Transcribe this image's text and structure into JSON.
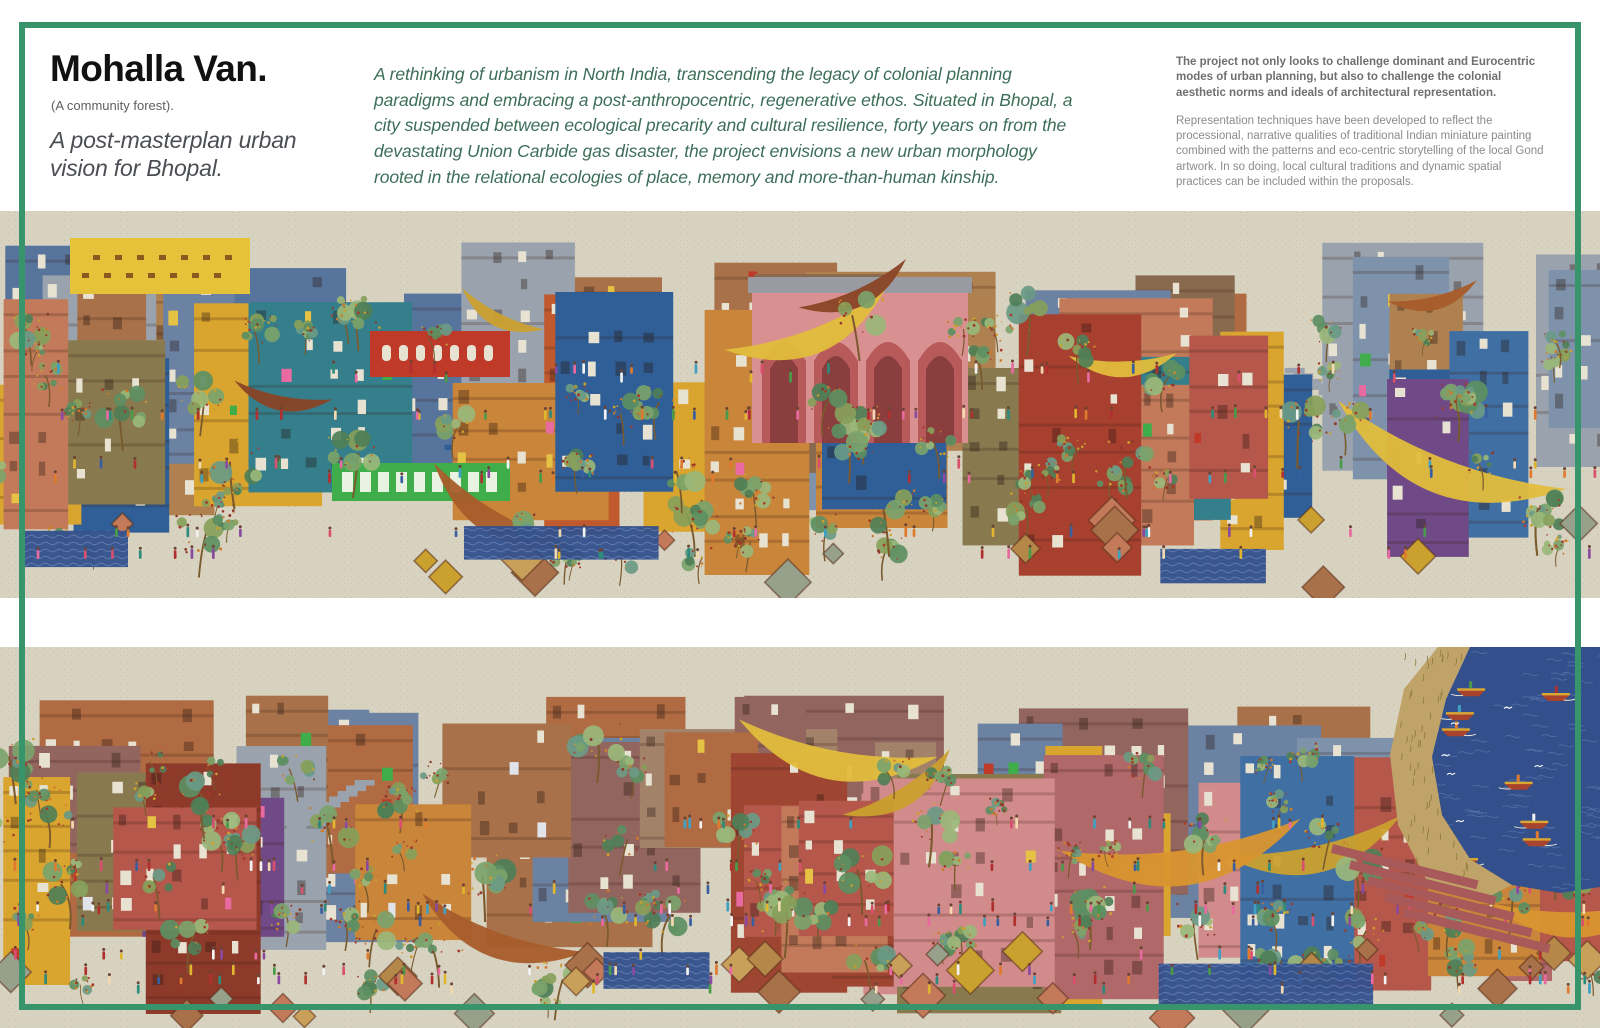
{
  "header": {
    "title": "Mohalla Van.",
    "subtitle": "(A community forest).",
    "tagline": "A post-masterplan urban vision for Bhopal.",
    "intro": "A rethinking of urbanism in North India, transcending the legacy of colonial planning paradigms and embracing a post-anthropocentric, regenerative ethos. Situated in Bhopal, a city suspended between ecological precarity and cultural resilience, forty years on from the devastating Union Carbide gas disaster, the project envisions a new urban morphology rooted in the relational ecologies of place, memory and more-than-human kinship.",
    "statement_bold": "The project not only looks to challenge dominant and Eurocentric modes of urban planning, but also to challenge the colonial aesthetic norms and ideals of architectural representation.",
    "statement_body": "Representation techniques have been developed to reflect the processional, narrative qualities of traditional Indian miniature painting combined with the patterns and eco-centric storytelling of the local Gond artwork. In so doing, local cultural traditions and dynamic spatial practices can be included within the proposals."
  },
  "illustration": {
    "bands": [
      {
        "name": "upper-panorama"
      },
      {
        "name": "lower-panorama"
      }
    ],
    "palette": {
      "canvas": "#d8d3c1",
      "speckle": "#b3a88c",
      "frame_green": "#38946b",
      "buildings_back": [
        "#b06b42",
        "#8e5a3a",
        "#6b82a3",
        "#8a6a4f",
        "#9aa3ad",
        "#7e93ab",
        "#a8714a",
        "#93655f",
        "#b08150",
        "#56749c",
        "#a3826a"
      ],
      "buildings_front": [
        "#a8402f",
        "#c05a2e",
        "#3f6fa3",
        "#2f5f96",
        "#d9a52f",
        "#c9853a",
        "#d28b8b",
        "#b5574a",
        "#6f4a87",
        "#357f8c",
        "#8e3a2b",
        "#c27a5a",
        "#9e4632",
        "#b06868",
        "#88794f"
      ],
      "accents": [
        "#e6c244",
        "#3fae4a",
        "#c03a2a",
        "#e0e4ea",
        "#e86aa0"
      ],
      "tree_greens": [
        "#5d8f62",
        "#7ba36b",
        "#9ab77a",
        "#6a9a86",
        "#87a05a",
        "#4f7f57"
      ],
      "tree_dots": [
        "#a6392a",
        "#cc7a2e",
        "#caa02e",
        "#8e3a2b"
      ],
      "people": [
        "#d94f6e",
        "#e0b62f",
        "#3fa0c2",
        "#4a9a4a",
        "#b03030",
        "#f2f2f2",
        "#8a4aa0",
        "#e07a2e",
        "#3a5fa0",
        "#e86aa0",
        "#2e8a7a",
        "#f2d9b0"
      ],
      "crescents": [
        "#e2bd3c",
        "#d9952f",
        "#a85c2a",
        "#8a4526",
        "#caa02e"
      ],
      "window_light": "#e8e2d2",
      "window_dark": "rgba(40,22,16,0.35)",
      "stairs": [
        "#3f6fa3",
        "#8094ad",
        "#2f5f96",
        "#9aa3ad"
      ],
      "roofs": [
        "#c9a05a",
        "#b5884a",
        "#97a08a",
        "#c27a5a",
        "#a8714a",
        "#caa02e"
      ],
      "lake": {
        "water": "#33508c",
        "wave": "#5a76ad",
        "foam": "#ffffff",
        "shore": "#c0a368",
        "grass": "#8a7a3a",
        "ghat": "#a85a5a",
        "boat_hull": "#a8432e",
        "boat_trim": "#d9a832"
      },
      "landmarks": {
        "sign_yellow": "#e6c23a",
        "sign_marks": "#8a5a20",
        "banner_red": "#c03a2a",
        "shelf_green": "#3fae4a",
        "pavilion_wall": "#d99090",
        "pavilion_arch": "#b85a5a",
        "pavilion_arch_inner": "#8a3e3e",
        "pavilion_roof": "#9a9aa2"
      }
    }
  }
}
